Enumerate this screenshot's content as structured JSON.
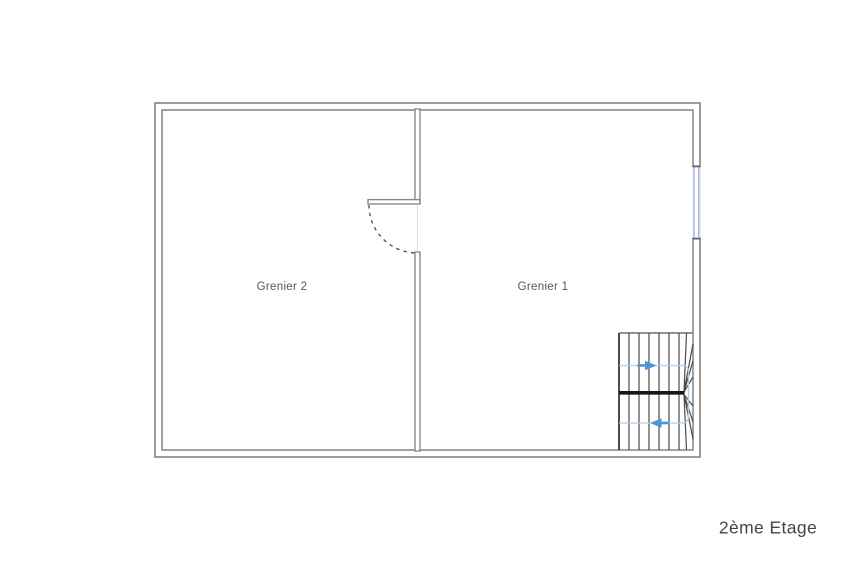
{
  "page": {
    "background": "#ffffff"
  },
  "floor_plan": {
    "floor_label": "2ème Etage",
    "rooms": [
      {
        "label": "Grenier 2"
      },
      {
        "label": "Grenier 1"
      }
    ],
    "stairs": {
      "up_arrow_icon": "arrow-right",
      "down_arrow_icon": "arrow-left"
    },
    "colors": {
      "wall_line": "#8a8a8a",
      "tread_line": "#4a4a4a",
      "thick_nosing_line": "#161616",
      "walk_line": "#b3cfe9",
      "arrow": "#4e95d6",
      "window": "#a9b3dc",
      "door_swing": "#4a4a4a",
      "room_label": "#555555",
      "floor_label": "#45454b"
    }
  }
}
